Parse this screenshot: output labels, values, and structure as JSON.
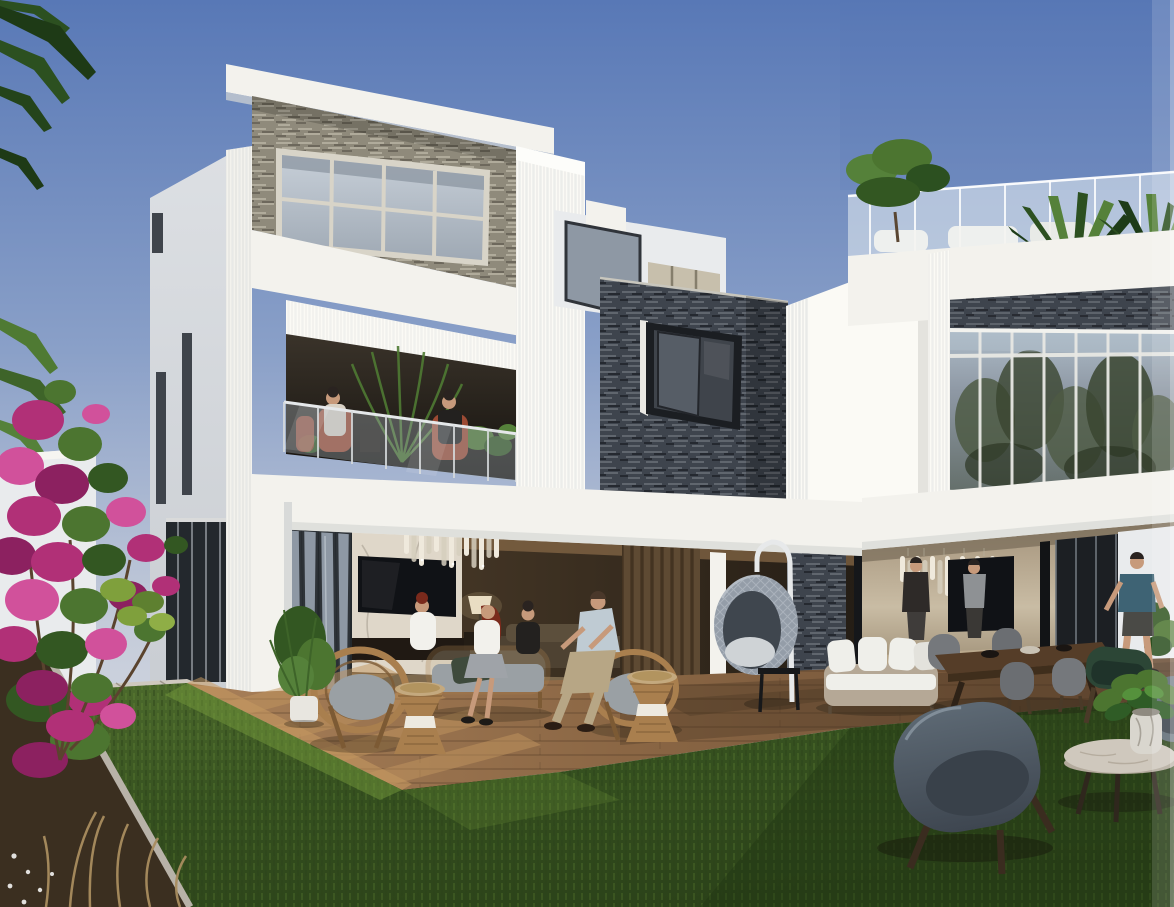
{
  "scene": {
    "type": "architectural-render",
    "description": "Photorealistic rendering of a modern two-storey villa: white geometric volumes with fluted trim, dark slate stone feature walls, large glazing reflecting trees, an open ground-floor lounge with chandeliers and TV, a furnished timber deck with wicker seating and a hanging egg chair, a lawn with foreground lounge chairs and a marble coffee table, and a magenta bougainvillea in bloom on the left.",
    "time_of_day": "late afternoon sun from the left",
    "people_count": 9,
    "objects": [
      "sky",
      "palm-fronds-top-left",
      "white-villa-left-wing",
      "stone-band-grid-window",
      "second-floor-balcony-with-seating",
      "slate-stone-tower-with-window",
      "fluted-white-fin-wall",
      "roof-terrace-glass-railing-and-palms",
      "glass-curtain-wall-tree-reflections",
      "ground-floor-lounge-chandelier-tv",
      "right-lounge-two-men-and-art-panel",
      "hanging-egg-chair",
      "wicker-seating-group-with-drum-tables",
      "white-garden-sofa",
      "outdoor-dining-set",
      "man-in-teal-shirt",
      "timber-deck-sun-stripes",
      "paver-path",
      "lawn",
      "flower-bed-with-dry-grasses",
      "bougainvillea",
      "foreground-armchair",
      "green-chair",
      "round-marble-coffee-table-with-plant"
    ]
  },
  "palette": {
    "sky_top": "#5878B6",
    "sky_mid": "#8AA0C8",
    "sky_low": "#C4CBD9",
    "sky_horizon": "#D6DAE3",
    "wall_lit": "#F3F2ED",
    "wall_warmlit": "#FBFAF5",
    "wall_shade": "#DCDFE3",
    "wall_cool": "#E9EBED",
    "flute_line": "#E6E7E6",
    "flute_shadow": "#C2C4C6",
    "stone_dark": "#3E444D",
    "stone_dark_hi": "#6F757C",
    "stone_dark_lo": "#22262C",
    "stone_light": "#8F8A7B",
    "stone_light_hi": "#B8B3A3",
    "stone_light_lo": "#5E594E",
    "glass_pale": "#B9C2CC",
    "glass_mid": "#8E98A4",
    "glass_dark": "#3F444B",
    "glass_frame": "#2E3338",
    "mullion": "#D8D4C8",
    "refl_tree": "#4E5A44",
    "refl_tree_dark": "#394530",
    "refl_sky": "#AFBDC9",
    "interior_warm": "#8A6B49",
    "interior_dark": "#3A3027",
    "wood_slat": "#5E4A33",
    "marble_wall": "#DFD7C9",
    "marble_vein": "#A9A092",
    "tv_black": "#101216",
    "lamp_shade": "#E8DFC9",
    "chand_glass": "#EFE9DC",
    "chand_glass2": "#D6CFBE",
    "deck_light": "#A87F58",
    "deck_mid": "#8A6644",
    "deck_shadow": "#6A4D35",
    "deck_stripe": "#C2965F",
    "paver": "#CFC9BF",
    "paver_joint": "#9E978C",
    "grass_bright": "#7AA03E",
    "grass_mid": "#4E6C2D",
    "grass_dark": "#35501F",
    "grass_deep": "#2B4219",
    "soil": "#3B2F20",
    "curb": "#B8B2A8",
    "dry_grass": "#A98D5F",
    "bgv_pink": "#B13077",
    "bgv_pink_hi": "#D1519B",
    "bgv_pink_lo": "#8C2160",
    "leaf": "#4C7530",
    "leaf_dark": "#335722",
    "palm": "#2C5020",
    "palm_hi": "#55813A",
    "rattan": "#A97F4E",
    "rattan_dark": "#7C5A34",
    "cushion_grey": "#9AA0A4",
    "pillow_dark": "#3E4A3C",
    "egg_grey": "#949DA8",
    "egg_hi": "#BCC3CB",
    "egg_inner": "#3F464E",
    "stand_white": "#E7E9EA",
    "sofa_base": "#B5A896",
    "sofa_white": "#EFEFEA",
    "table_wood": "#553D28",
    "chair_grey": "#75787C",
    "chair_green": "#2C4636",
    "shell_grey": "#5D6974",
    "shell_dark": "#3E4650",
    "marble_top": "#CFC8BD",
    "vase": "#D9D6CE",
    "skin": "#C79A7B",
    "hair_dark": "#2A2320",
    "hair_red": "#7A2A1C",
    "shirt_white": "#F2F1EC",
    "shirt_blue": "#BFCBD3",
    "shirt_black": "#23211F",
    "shirt_grey": "#8E9194",
    "shirt_teal": "#3E6374",
    "pants_khaki": "#B7A685",
    "shorts_dark": "#4A4A46",
    "terracotta": "#9C4A33"
  }
}
